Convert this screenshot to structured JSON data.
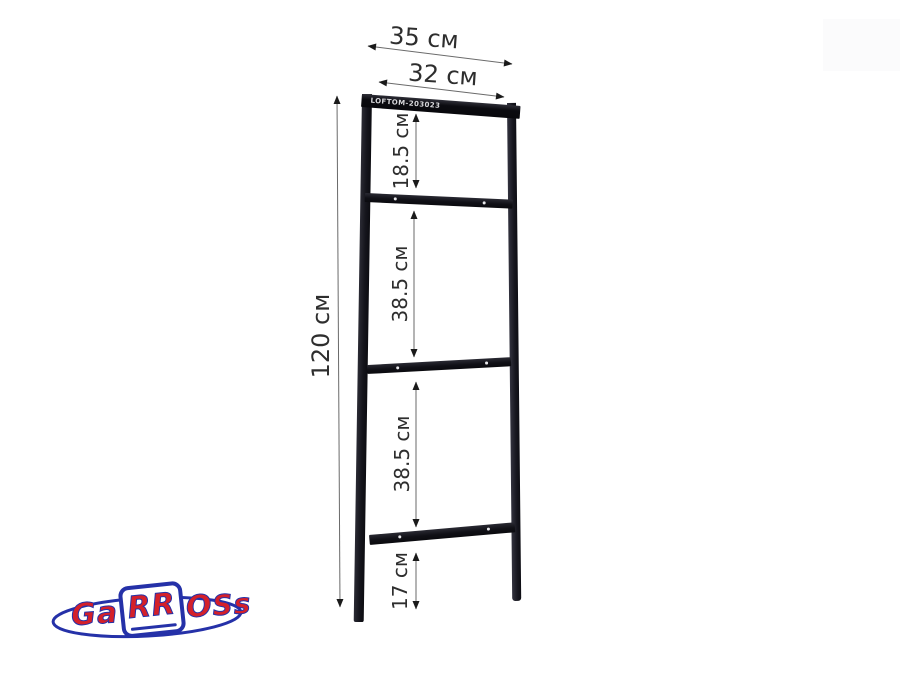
{
  "product": {
    "frame_label": "LOFTOM-203023"
  },
  "dimensions": {
    "outer_width": "35 см",
    "inner_width": "32 см",
    "total_height": "120 см",
    "sections": [
      "18.5 см",
      "38.5 см",
      "38.5 см",
      "17 см"
    ]
  },
  "logo": {
    "brand": "Garross",
    "part_ga": "Ga",
    "part_rr": "RR",
    "part_o": "O",
    "part_ss": "Ss"
  },
  "colors": {
    "frame_dark": "#101016",
    "dimension_text": "#2e2e2e",
    "arrow_line": "#6a6a6a",
    "arrow_head": "#1a1a1a",
    "logo_red": "#d4202a",
    "logo_blue": "#2531a8"
  }
}
